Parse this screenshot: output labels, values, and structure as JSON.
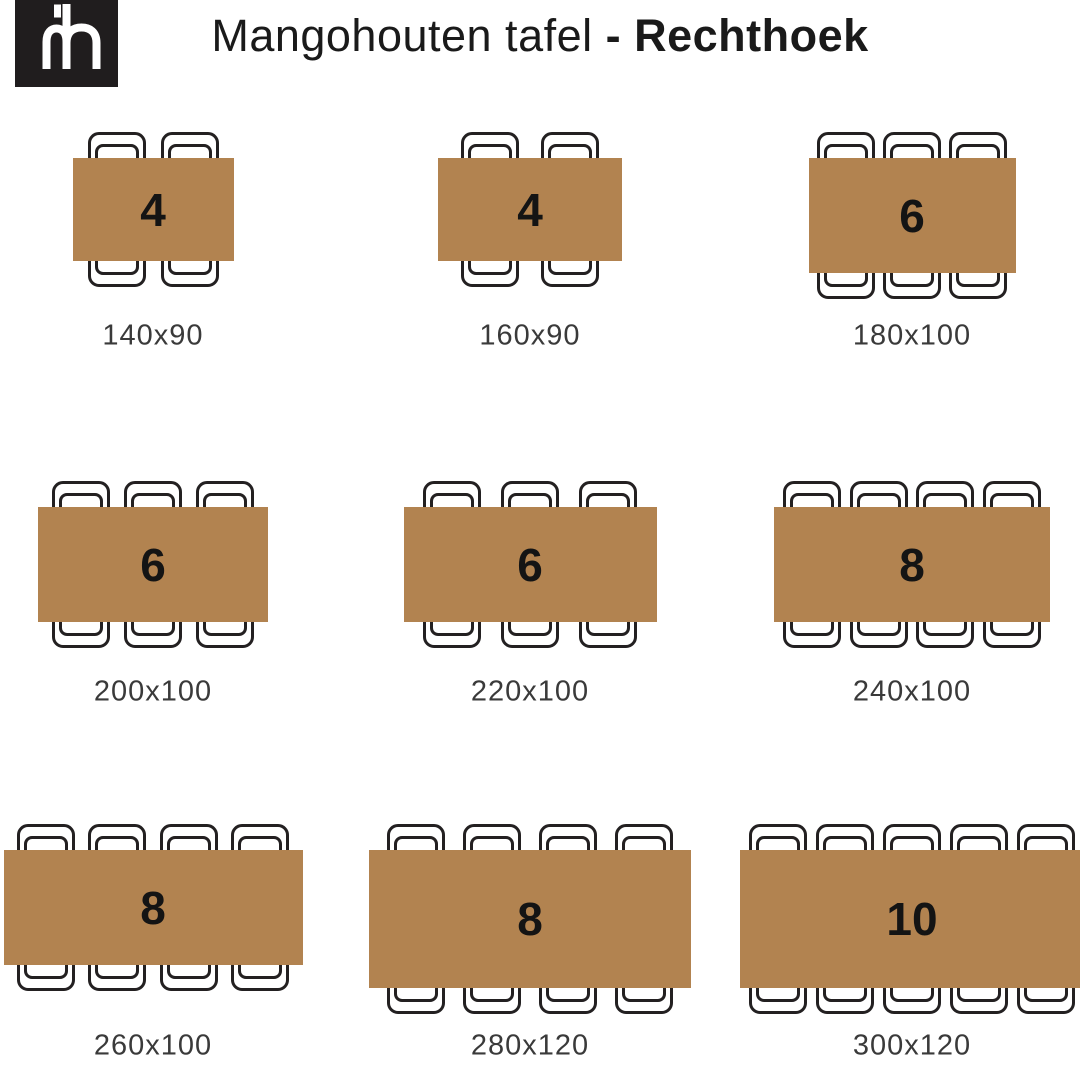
{
  "header": {
    "logo_monogram": "mh",
    "title_regular": "Mangohouten tafel ",
    "title_bold": "- Rechthoek"
  },
  "tables": [
    {
      "seats": 4,
      "size": "140x90"
    },
    {
      "seats": 4,
      "size": "160x90"
    },
    {
      "seats": 6,
      "size": "180x100"
    },
    {
      "seats": 6,
      "size": "200x100"
    },
    {
      "seats": 6,
      "size": "220x100"
    },
    {
      "seats": 8,
      "size": "240x100"
    },
    {
      "seats": 8,
      "size": "260x100"
    },
    {
      "seats": 8,
      "size": "280x120"
    },
    {
      "seats": 10,
      "size": "300x120"
    }
  ],
  "colors": {
    "table_fill": "#b28350",
    "outline": "#232021",
    "number": "#141414",
    "label": "#3a3a3a",
    "title": "#1a1a1a",
    "logo_background": "#201d1e",
    "logo_foreground": "#ffffff"
  }
}
